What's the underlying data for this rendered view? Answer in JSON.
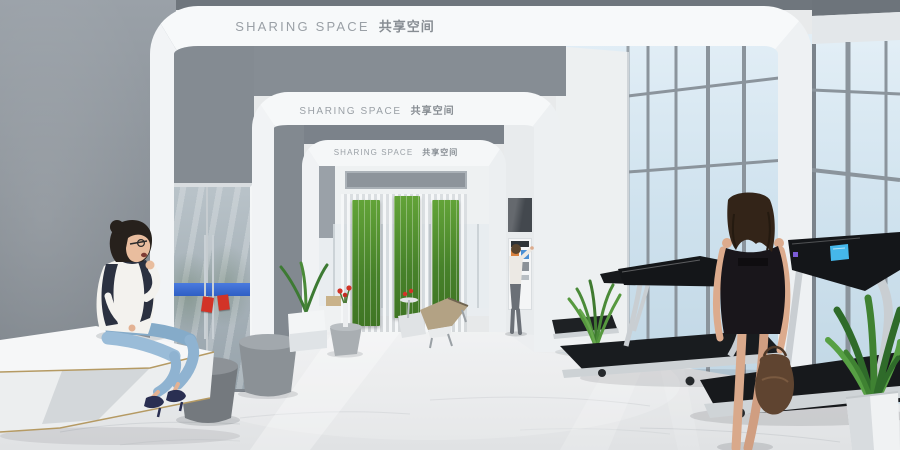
{
  "scene_title": "SHARING SPACE 共享空间",
  "portals": [
    {
      "label_en": "SHARING SPACE",
      "label_zh": "共享空间"
    },
    {
      "label_en": "SHARING SPACE",
      "label_zh": "共享空间"
    },
    {
      "label_en": "SHARING SPACE",
      "label_zh": "共享空间"
    }
  ],
  "colors": {
    "wall_gray": "#858c93",
    "portal_white": "#f6f8f9",
    "label_gray": "#9aa0a6",
    "moss_green": "#4f8c2c",
    "glass_blue": "#cfe2ee",
    "floor_light": "#e8eaeb",
    "door_band_blue": "#3a6ed2",
    "tag_red": "#d23327",
    "treadmill_black": "#17191c",
    "frame_silver": "#c9ced2",
    "screen_blue": "#45b7ea"
  }
}
